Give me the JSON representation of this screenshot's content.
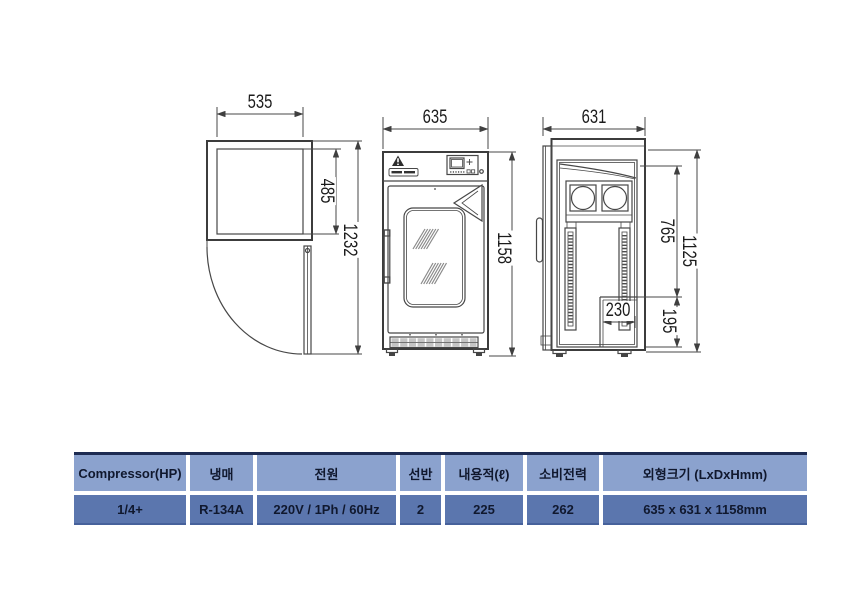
{
  "drawing": {
    "top_view": {
      "width": "535",
      "depth": "485",
      "door_swing": "1232"
    },
    "front_view": {
      "width": "635",
      "height": "1158"
    },
    "side_view": {
      "depth": "631",
      "interior_height": "765",
      "height": "1125",
      "recess_depth": "230",
      "recess_height": "195"
    }
  },
  "spec_table": {
    "headers": [
      "Compressor(HP)",
      "냉매",
      "전원",
      "선반",
      "내용적(ℓ)",
      "소비전력",
      "외형크기 (LxDxHmm)"
    ],
    "values": [
      "1/4+",
      "R-134A",
      "220V / 1Ph / 60Hz",
      "2",
      "225",
      "262",
      "635 x 631 x 1158mm"
    ],
    "colors": {
      "header_bg": "#8BA2CE",
      "value_bg": "#5B76AE",
      "top_border": "#1D2B52",
      "text": "#10182E",
      "line_art": "#444444"
    }
  }
}
